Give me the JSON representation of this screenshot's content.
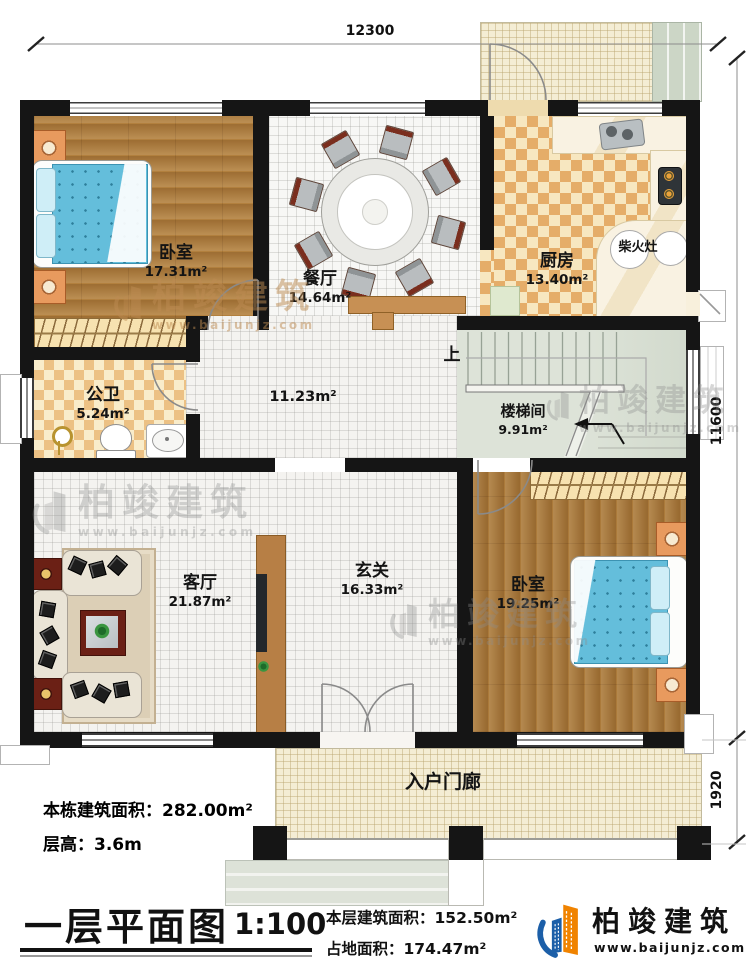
{
  "plan": {
    "dimensions": {
      "top": "12300",
      "right_upper": "11600",
      "right_lower": "1920"
    },
    "rooms": {
      "bedroom_top": {
        "name": "卧室",
        "area": "17.31m²"
      },
      "dining": {
        "name": "餐厅",
        "area": "14.64m²"
      },
      "kitchen": {
        "name": "厨房",
        "area": "13.40m²",
        "wood_stove": "柴火灶"
      },
      "bathroom": {
        "name": "公卫",
        "area": "5.24m²"
      },
      "hallway": {
        "area": "11.23m²"
      },
      "stairwell": {
        "name": "楼梯间",
        "area": "9.91m²",
        "up_label": "上"
      },
      "living": {
        "name": "客厅",
        "area": "21.87m²"
      },
      "foyer": {
        "name": "玄关",
        "area": "16.33m²"
      },
      "bedroom_bottom": {
        "name": "卧室",
        "area": "19.25m²"
      },
      "entry_porch": {
        "name": "入户门廊"
      }
    },
    "notes": {
      "total_building_area": "本栋建筑面积：282.00m²",
      "floor_height": "层高：3.6m"
    }
  },
  "title_block": {
    "title": "一层平面图",
    "scale": "1:100",
    "floor_area": "本层建筑面积：152.50m²",
    "footprint_area": "占地面积：174.47m²"
  },
  "brand": {
    "name": "柏竣建筑",
    "url": "www.baijunjz.com"
  },
  "colors": {
    "wall": "#151515",
    "logo_blue": "#1c5fa8",
    "logo_orange": "#f08300",
    "wood": "#b2803e",
    "bed": "#64bedb"
  }
}
